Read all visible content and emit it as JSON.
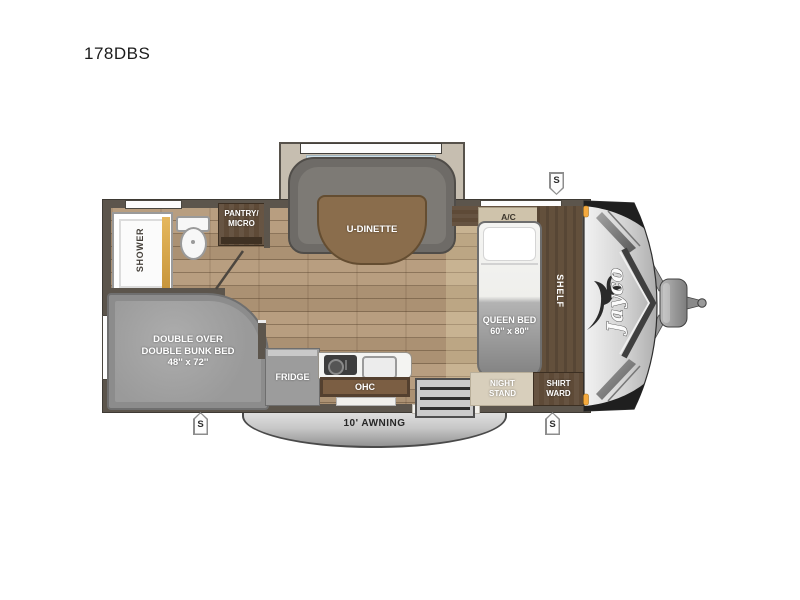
{
  "title": "178DBS",
  "brand": "Jayco",
  "speaker_label": "S",
  "colors": {
    "wall": "#5c554c",
    "floor_wood": "#b1977a",
    "bedroom_wood": "#c3ad8d",
    "cabinet_walnut": "#5e4a37",
    "shower_door_gold": "#d9a94e",
    "marker_light_amber": "#f5a93d",
    "bench_gray": "#6e6b67",
    "awning_gray": "#c7c7c7"
  },
  "rooms": {
    "shower": "SHOWER",
    "pantry_line1": "PANTRY/",
    "pantry_line2": "MICRO",
    "dinette": "U-DINETTE",
    "ac": "A/C",
    "queen_line1": "QUEEN BED",
    "queen_line2": "60'' x 80''",
    "shelf": "SHELF",
    "bunk_line1": "DOUBLE OVER",
    "bunk_line2": "DOUBLE BUNK BED",
    "bunk_line3": "48'' x 72''",
    "fridge": "FRIDGE",
    "ohc": "OHC",
    "night_line1": "NIGHT",
    "night_line2": "STAND",
    "shirt_line1": "SHIRT",
    "shirt_line2": "WARD",
    "awning": "10' AWNING"
  }
}
